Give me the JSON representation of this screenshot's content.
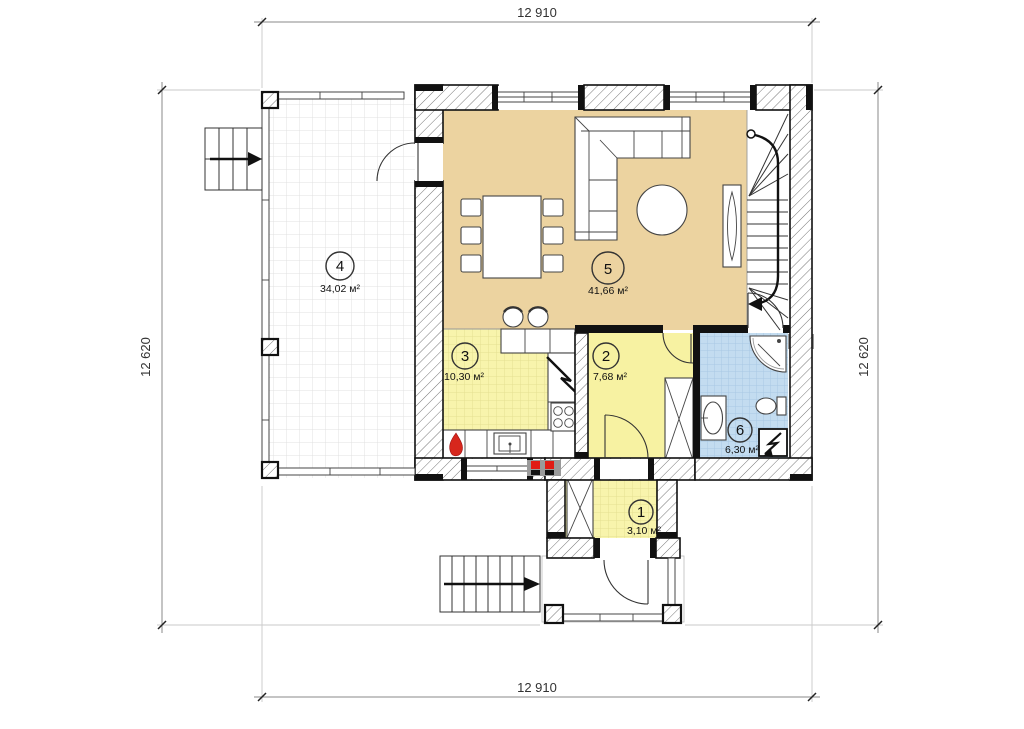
{
  "plan": {
    "type": "floor-plan",
    "dimensions": {
      "top": "12 910",
      "bottom": "12 910",
      "left": "12 620",
      "right": "12 620"
    },
    "rooms": {
      "r1": {
        "number": "1",
        "area": "3,10 м²"
      },
      "r2": {
        "number": "2",
        "area": "7,68 м²"
      },
      "r3": {
        "number": "3",
        "area": "10,30 м²"
      },
      "r4": {
        "number": "4",
        "area": "34,02 м²"
      },
      "r5": {
        "number": "5",
        "area": "41,66 м²"
      },
      "r6": {
        "number": "6",
        "area": "6,30 м²"
      }
    },
    "colors": {
      "living_room_floor": "#ECD3A0",
      "kitchen_floor": "#F8F4AC",
      "hall_floor": "#F7F2A2",
      "bathroom_floor": "#C3DCF0",
      "wall": "#111111",
      "accent_red": "#E01B14"
    }
  }
}
